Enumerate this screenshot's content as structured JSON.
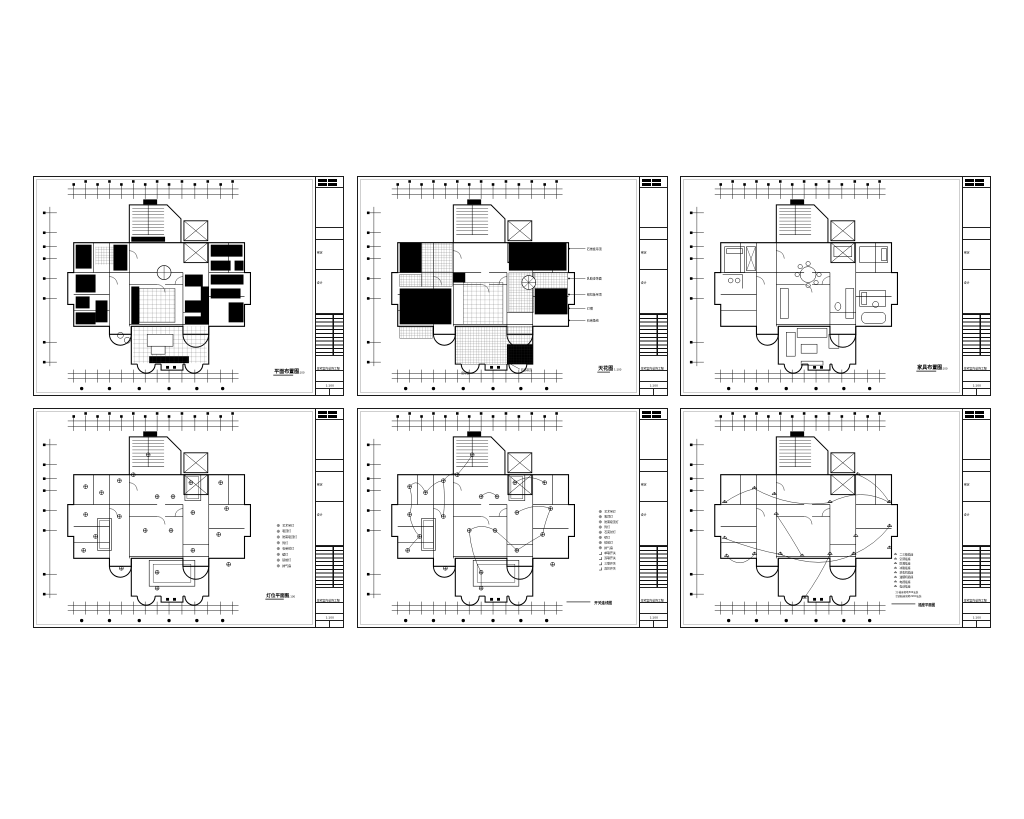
{
  "page": {
    "background": "#ffffff",
    "ink": "#000000"
  },
  "title_block": {
    "project": "住宅室内装饰工程",
    "fields": [
      "审定",
      "设计"
    ],
    "scale": "1:100"
  },
  "sheets": [
    {
      "title": "平面布置图",
      "scale": "1:100",
      "variant": "dark"
    },
    {
      "title": "天花图",
      "scale": "1:100",
      "variant": "ceiling",
      "leaders": [
        "石膏板吊顶",
        "乳胶漆饰面",
        "铝扣板吊顶",
        "灯槽",
        "石膏角线"
      ],
      "notes": [
        "局部吊顶",
        "窗帘盒"
      ]
    },
    {
      "title": "家具布置图",
      "scale": "1:100",
      "variant": "light"
    },
    {
      "title": "灯位平面图",
      "scale": "1:100",
      "variant": "lighting",
      "legend": [
        "艺术吊灯",
        "吸顶灯",
        "防雾吸顶灯",
        "筒灯",
        "石英射灯",
        "壁灯",
        "镜前灯",
        "排气扇"
      ]
    },
    {
      "title": "开关连线图",
      "scale": "1:100",
      "variant": "wiring",
      "legend": [
        "艺术吊灯",
        "吸顶灯",
        "防雾吸顶灯",
        "筒灯",
        "石英射灯",
        "壁灯",
        "镜前灯",
        "排气扇",
        "单联开关",
        "双联开关",
        "三联开关",
        "双控开关"
      ]
    },
    {
      "title": "插座平面图",
      "scale": "1:100",
      "variant": "socket",
      "legend": [
        "二三极插座",
        "空调插座",
        "防溅插座",
        "冰箱插座",
        "洗衣机插座",
        "油烟机插座",
        "电视插座",
        "电话插座"
      ],
      "notes": [
        "注:插座离地300安装",
        "空调插座离地2200安装"
      ],
      "legend_label": "图例"
    }
  ]
}
